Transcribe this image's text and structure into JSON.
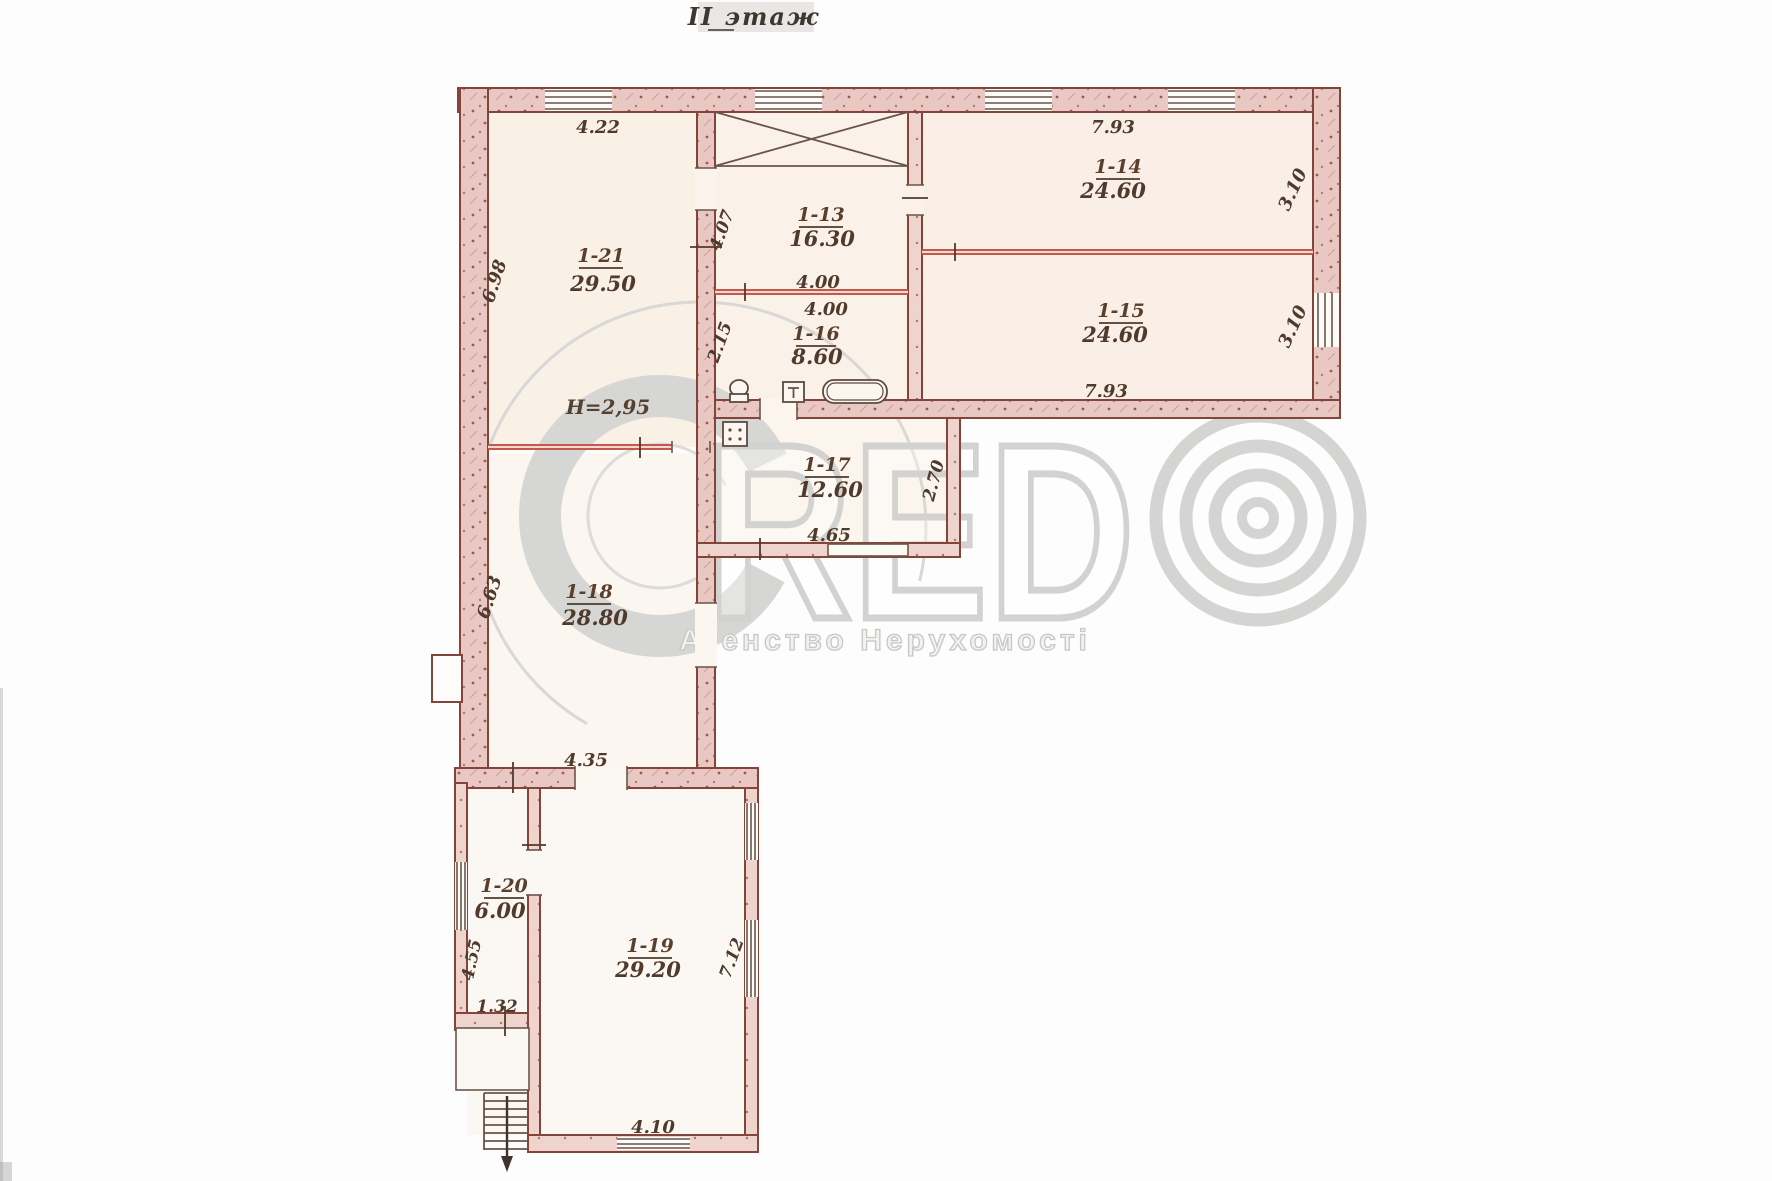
{
  "title": "II этаж",
  "height_note": "H=2,95",
  "watermark": {
    "brand_red": "RED",
    "subtitle": "Агенство Нерухомості",
    "color": "#d2d2d0"
  },
  "rooms": {
    "r13": {
      "id": "1-13",
      "area": "16.30"
    },
    "r14": {
      "id": "1-14",
      "area": "24.60"
    },
    "r15": {
      "id": "1-15",
      "area": "24.60"
    },
    "r16": {
      "id": "1-16",
      "area": "8.60"
    },
    "r17": {
      "id": "1-17",
      "area": "12.60"
    },
    "r18": {
      "id": "1-18",
      "area": "28.80"
    },
    "r19": {
      "id": "1-19",
      "area": "29.20"
    },
    "r20": {
      "id": "1-20",
      "area": "6.00"
    },
    "r21": {
      "id": "1-21",
      "area": "29.50"
    }
  },
  "dims": {
    "top_4_22": "4.22",
    "top_7_93": "7.93",
    "right_3_10_a": "3.10",
    "right_3_10_b": "3.10",
    "left_6_98": "6.98",
    "mid_4_07": "4.07",
    "mid_4_00_a": "4.00",
    "mid_4_00_b": "4.00",
    "mid_2_15": "2.15",
    "bot_7_93": "7.93",
    "r17_2_70": "2.70",
    "r17_4_65": "4.65",
    "left_6_63": "6.63",
    "r18_4_35": "4.35",
    "left_4_55": "4.55",
    "left_1_32": "1.32",
    "right_7_12": "7.12",
    "bot_4_10": "4.10"
  },
  "symbols": {
    "staircase": "crossed-box",
    "stairs_down": "arrow-down",
    "bathtub": "tub-outline",
    "toilet": "toilet-outline",
    "sink": "square-T",
    "stove": "square-dots"
  },
  "colors": {
    "wall_fill": "#e9c8c3",
    "wall_stroke": "#83453a",
    "partition": "#c4584c",
    "ink": "#4f3a2c",
    "floor": "#f9f0e6"
  }
}
